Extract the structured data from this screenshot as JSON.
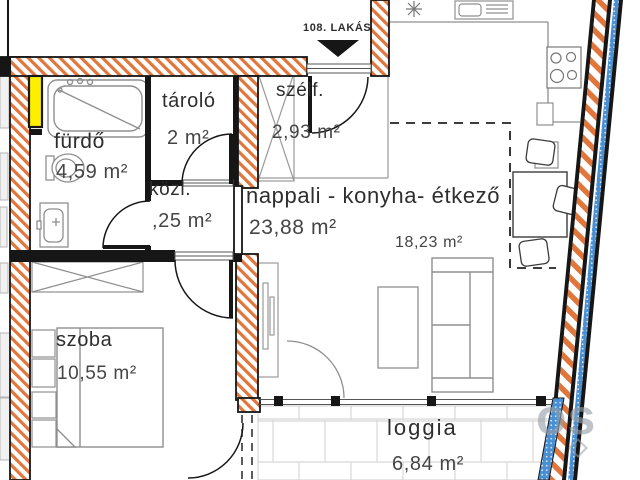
{
  "apartments": {
    "neighbor_label": "107. LAKÁS",
    "unit_label": "108. LAKÁS"
  },
  "rooms": {
    "bathroom": {
      "name": "fürdő",
      "area": "4,59 m²"
    },
    "storage": {
      "name": "tároló",
      "area": "2 m²"
    },
    "hallway": {
      "name": "közl.",
      "area": ",25 m²"
    },
    "vestibule": {
      "name": "szélf.",
      "area": "2,93 m²"
    },
    "living_kitchen_dining": {
      "name": "nappali - konyha- étkező",
      "area": "23,88 m²",
      "sub_area": "18,23 m²"
    },
    "bedroom": {
      "name": "szoba",
      "area": "10,55 m²"
    },
    "loggia": {
      "name": "loggia",
      "area": "6,84 m²"
    }
  },
  "watermark": {
    "text": "os"
  },
  "colors": {
    "wall_hatch_orange": "#e0763c",
    "highlight_yellow": "#ffef00",
    "glazing_blue": "#4a8fd2",
    "line_black": "#161616",
    "furniture_grey": "#8f8f8f",
    "tile_grey": "#d8d8d8",
    "text_dark": "#2e2e2e",
    "watermark_grey": "#949ea6"
  }
}
